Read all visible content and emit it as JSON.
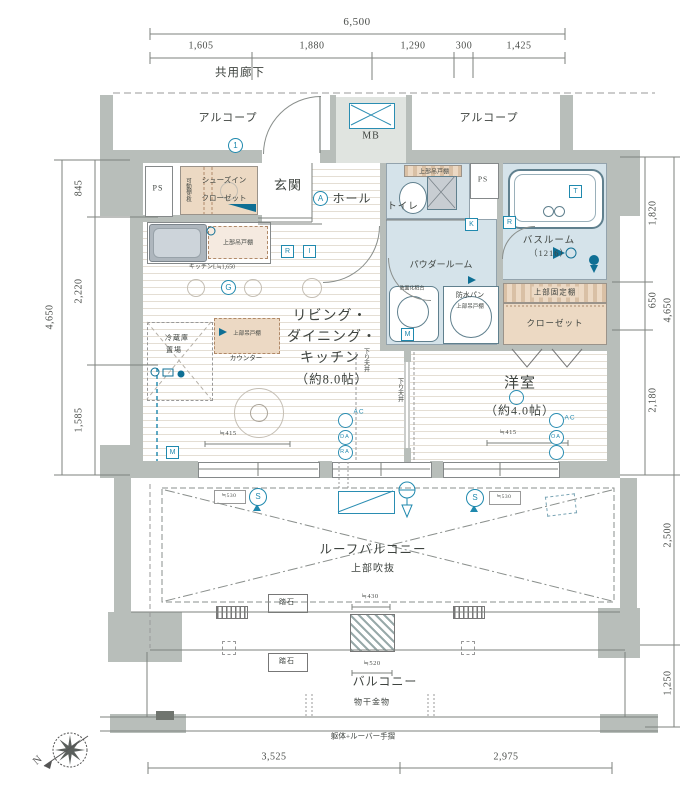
{
  "dims": {
    "top_total": "6,500",
    "top_segs": [
      "1,605",
      "1,880",
      "1,290",
      "300",
      "1,425"
    ],
    "left_total": "4,650",
    "left_segs": [
      "845",
      "2,220",
      "1,585"
    ],
    "right_segs": [
      "1,820",
      "650",
      "2,180"
    ],
    "right_total": "4,650",
    "right_roof": "2,500",
    "right_balcony": "1,250",
    "bottom_segs": [
      "3,525",
      "2,975"
    ],
    "win_left": "≒415",
    "win_right": "≒415",
    "gap_left": "≒530",
    "gap_right": "≒530",
    "step_top": "≒430",
    "step_bottom": "≒520",
    "kitchen_len": "キッチンL≒1,650"
  },
  "areas": {
    "corridor": "共用廊下",
    "alcove_left": "アルコープ",
    "alcove_right": "アルコープ",
    "mb": "MB",
    "ps_left": "PS",
    "ps_right": "PS",
    "sic_line1": "シューズイン",
    "sic_line2": "クローゼット",
    "sic_shelf": "可動棚6枚",
    "genkan": "玄関",
    "hall": "ホール",
    "toilet": "トイレ",
    "toilet_cab": "上部吊戸棚",
    "bath_line1": "バスルーム",
    "bath_line2": "（1216）",
    "powder": "パウダールーム",
    "pan": "防水パン",
    "pan_cab": "上部吊戸棚",
    "vanity": "洗面化粧台",
    "shelf_fixed": "上部固定棚",
    "closet": "クローゼット",
    "ldk_line1": "リビング・",
    "ldk_line2": "ダイニング・",
    "ldk_line3": "キッチン",
    "ldk_line4": "（約8.0帖）",
    "yoshitsu_line1": "洋室",
    "yoshitsu_line2": "（約4.0帖）",
    "kitchen_cab": "上部吊戸棚",
    "counter_cab": "上部吊戸棚",
    "counter": "カウンター",
    "fridge_line1": "冷蔵庫",
    "fridge_line2": "置場",
    "down_ceiling_left": "下り天井",
    "down_ceiling_right": "下り天井",
    "roof_balcony": "ルーフバルコニー",
    "void_above": "上部吹抜",
    "step1": "踏石",
    "step2": "踏石",
    "balcony": "バルコニー",
    "laundry": "物干金物",
    "handrail": "躯体+ルーバー手摺"
  },
  "marks": {
    "a": "A",
    "g": "G",
    "one": "1",
    "k": "K",
    "r1": "R",
    "i1": "I",
    "r2": "R",
    "t": "T",
    "m1": "M",
    "m2": "M",
    "s1": "S",
    "s2": "S",
    "ac1": "AC",
    "da": "DA",
    "ra": "RA",
    "ac2": "AC",
    "oa": "OA",
    "north": "N"
  },
  "colors": {
    "wall": "#b8beba",
    "wet_area": "#d5e3ea",
    "wood_area": "#ecd9c3",
    "accent_cyan": "#1f89ae",
    "line": "#85898a"
  }
}
